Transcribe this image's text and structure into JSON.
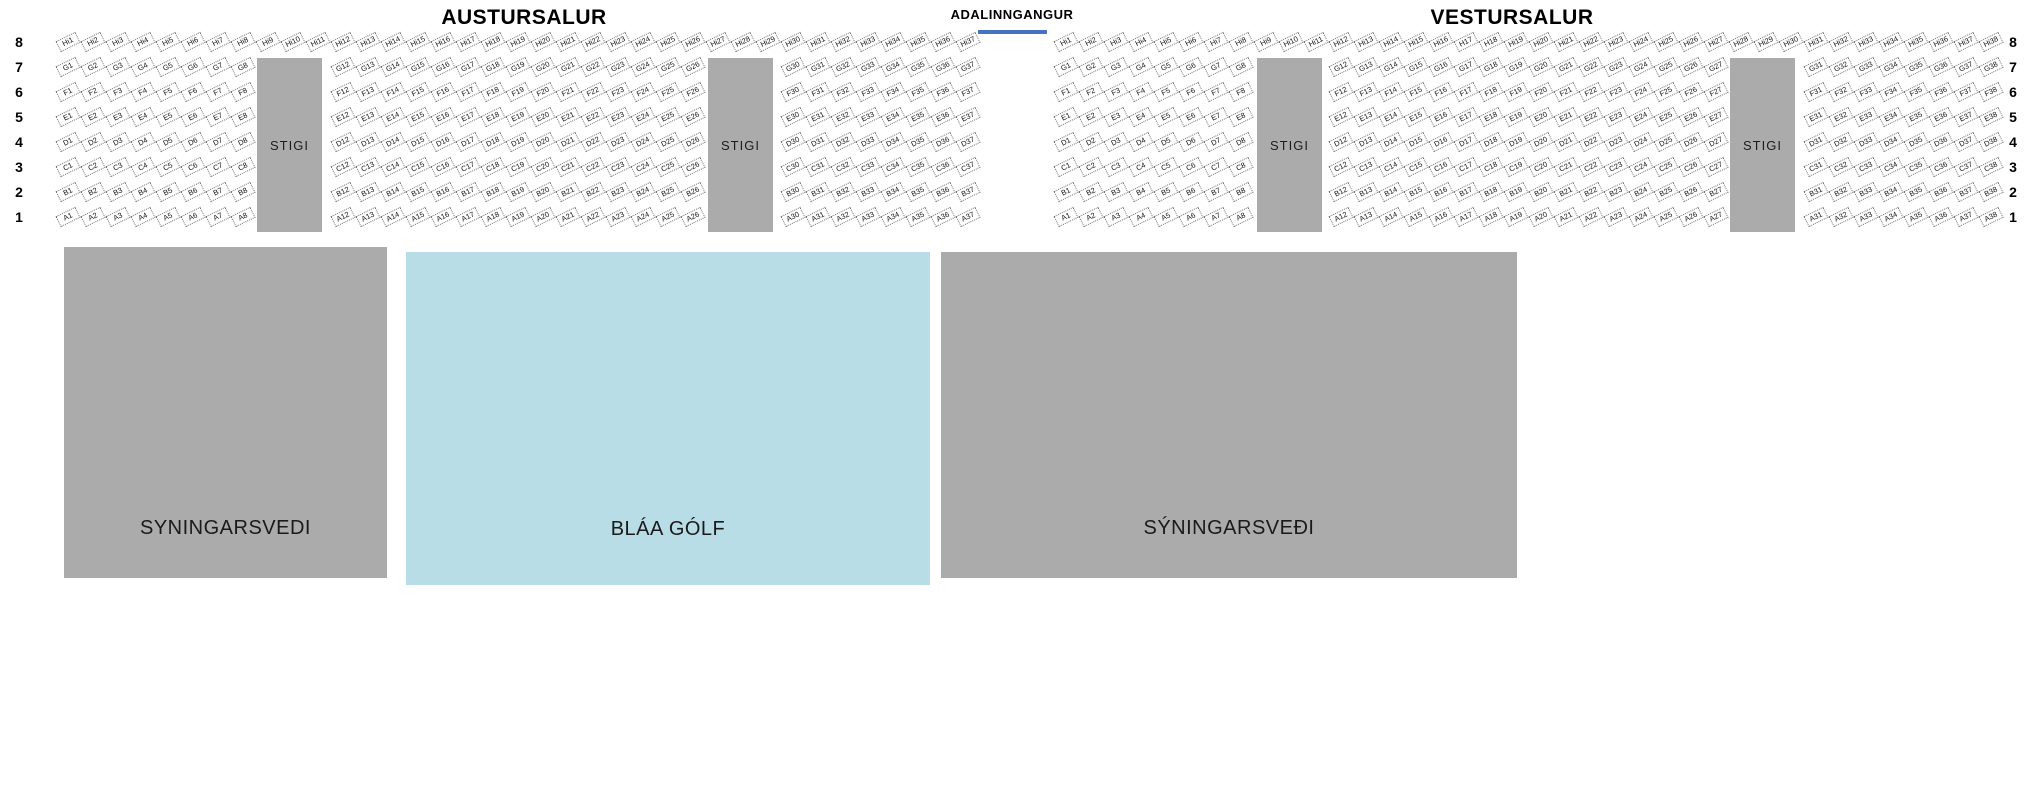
{
  "colors": {
    "block_gray": "#ababab",
    "floor_blue": "#b8dde6",
    "entrance_bar_blue": "#4472c4",
    "seat_fill": "#ffffff"
  },
  "row_numbers": [
    "8",
    "7",
    "6",
    "5",
    "4",
    "3",
    "2",
    "1"
  ],
  "entrance": {
    "label": "ADALINNGANGUR"
  },
  "halls": [
    {
      "id": "austursalur",
      "title": "AUSTURSALUR",
      "row8_prefix": "Hi",
      "row8_from": 1,
      "row8_to": 37,
      "row8_plain_h": [],
      "row_letters": [
        "G",
        "F",
        "E",
        "D",
        "C",
        "B",
        "A"
      ],
      "segments": [
        [
          1,
          8
        ],
        [
          12,
          26
        ],
        [
          30,
          37
        ]
      ],
      "stigi_labels": [
        "STIGI",
        "STIGI"
      ]
    },
    {
      "id": "vestursalur",
      "title": "VESTURSALUR",
      "row8_prefix": "Hi",
      "row8_from": 1,
      "row8_to": 38,
      "row8_plain_h": [
        17,
        18
      ],
      "row_letters": [
        "G",
        "F",
        "E",
        "D",
        "C",
        "B",
        "A"
      ],
      "segments": [
        [
          1,
          8
        ],
        [
          12,
          27
        ],
        [
          31,
          38
        ]
      ],
      "stigi_labels": [
        "STIGI",
        "STIGI"
      ]
    }
  ],
  "floor_areas": [
    {
      "id": "syningarsvedi-left",
      "label": "SYNINGARSVEDI"
    },
    {
      "id": "blaa-golf",
      "label": "BLÁA GÓLF"
    },
    {
      "id": "syningarsvedi-right",
      "label": "SÝNINGARSVEÐI"
    }
  ]
}
